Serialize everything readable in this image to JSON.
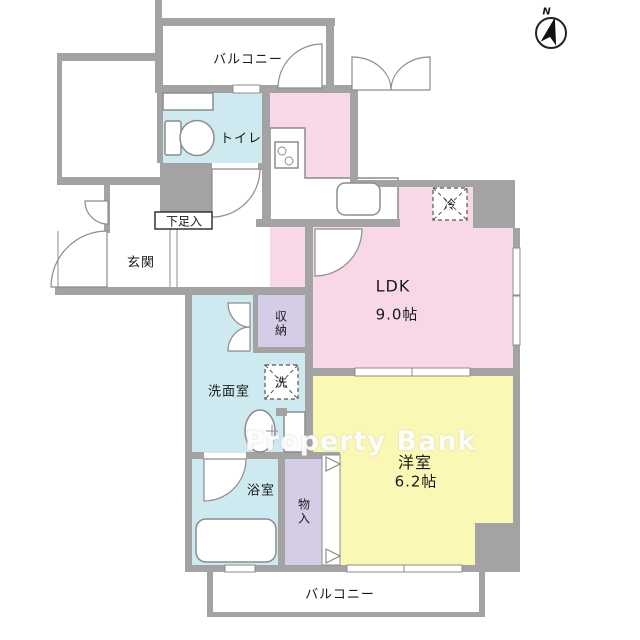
{
  "title": "apartment-floor-plan",
  "compass": {
    "label": "N"
  },
  "watermark": {
    "text": "Property Bank"
  },
  "rooms": {
    "balcony_top": "バルコニー",
    "toilet": "トイレ",
    "ldk": "LDK",
    "ldk_size": "9.0帖",
    "entrance": "玄関",
    "shoe_box": "下足入",
    "storage": "収納",
    "washroom": "洗面室",
    "washer": "洗",
    "fridge": "冷",
    "bathroom": "浴室",
    "closet": "物入",
    "western_room": "洋室",
    "western_room_size": "6.2帖",
    "balcony_bottom": "バルコニー"
  },
  "colors": {
    "c-wall": "#a3a3a3",
    "c-line": "#8c8c8c",
    "c-pink": "#f8d7e6",
    "c-yellow": "#fbf8b6",
    "c-blue": "#cfe9f0",
    "c-purple": "#d5cce6"
  }
}
